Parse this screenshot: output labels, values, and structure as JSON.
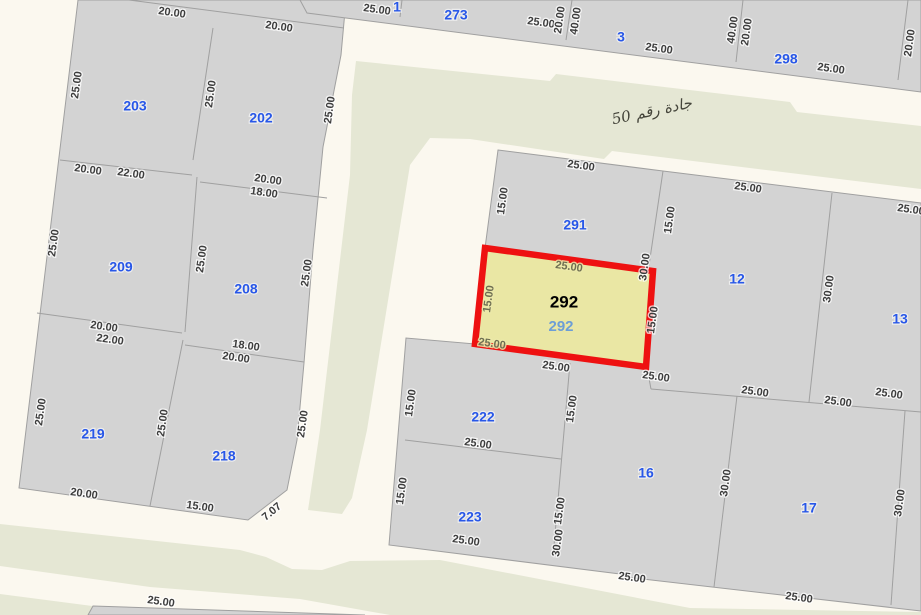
{
  "canvas": {
    "width": 921,
    "height": 615
  },
  "colors": {
    "road_background": "#fbf8ef",
    "street_pavement": "#e5e7d4",
    "parcel_fill": "#d3d3d3",
    "parcel_line": "#a0a0a0",
    "dimension_text": "#3d3d3d",
    "parcel_number_blue": "#2857e8",
    "selected_fill": "#eae7a4",
    "selected_border": "#ee1111",
    "selected_number_black": "#000000",
    "selected_number_blue": "#6d9ed6",
    "street_text": "#44443a"
  },
  "street": {
    "name": "جادة رقم 50",
    "x": 652,
    "y": 112,
    "angle": -12
  },
  "selected_parcel": {
    "number_black": "292",
    "number_blue": "292",
    "black_pos": {
      "x": 564,
      "y": 303
    },
    "blue_pos": {
      "x": 561,
      "y": 327
    },
    "points": "485,248 653,271 646,367 475,344"
  },
  "map": {
    "streets": [
      "356,61 550,81 556,74 790,102 797,112 921,126 921,189 612,151 604,159 470,139 430,138 410,165 367,430 352,498 342,514 308,510 320,430 350,175 352,95",
      "0,524 240,550 266,557 292,569 322,570 350,561 440,560 690,608 921,612 921,615 390,615 300,599 150,587 0,566",
      "0,594 100,607 96,615 0,615"
    ],
    "blocks": [
      "78,0 346,0 341,55 323,147 313,250 304,363 297,440 287,490 248,520 19,488",
      "300,0 921,0 921,92 307,13",
      "498,150 663,171 921,203 921,611 625,577 620,574 389,545 406,338 475,344 485,248",
      "93,606 365,615 88,615"
    ],
    "lines": [
      "129,0 344,28",
      "60,160 192,175",
      "200,182 327,198",
      "37,313 182,333",
      "185,345 304,362",
      "213,28 193,160",
      "197,177 185,332",
      "183,340 150,506",
      "402,0 400,17",
      "572,0 566,40",
      "743,0 736,62",
      "908,0 898,80",
      "663,171 648,272",
      "832,193 809,402",
      "647,368 651,389",
      "651,389 921,412",
      "405,440 561,459",
      "570,363 553,557",
      "737,396 714,587",
      "905,411 891,605"
    ],
    "dims": [
      {
        "t": "20.00",
        "x": 172,
        "y": 13,
        "r": 8
      },
      {
        "t": "20.00",
        "x": 279,
        "y": 27,
        "r": 8
      },
      {
        "t": "25.00",
        "x": 377,
        "y": 10,
        "r": 8
      },
      {
        "t": "25.00",
        "x": 541,
        "y": 23,
        "r": 8
      },
      {
        "t": "20.00",
        "x": 560,
        "y": 20,
        "r": -82
      },
      {
        "t": "40.00",
        "x": 576,
        "y": 21,
        "r": -82
      },
      {
        "t": "25.00",
        "x": 659,
        "y": 49,
        "r": 8
      },
      {
        "t": "40.00",
        "x": 733,
        "y": 30,
        "r": -82
      },
      {
        "t": "20.00",
        "x": 747,
        "y": 32,
        "r": -82
      },
      {
        "t": "25.00",
        "x": 831,
        "y": 69,
        "r": 8
      },
      {
        "t": "20.00",
        "x": 910,
        "y": 43,
        "r": -82
      },
      {
        "t": "25.00",
        "x": 77,
        "y": 85,
        "r": -82
      },
      {
        "t": "25.00",
        "x": 211,
        "y": 94,
        "r": -82
      },
      {
        "t": "25.00",
        "x": 330,
        "y": 110,
        "r": -82
      },
      {
        "t": "20.00",
        "x": 88,
        "y": 170,
        "r": 8
      },
      {
        "t": "22.00",
        "x": 131,
        "y": 174,
        "r": 8
      },
      {
        "t": "20.00",
        "x": 268,
        "y": 180,
        "r": 8
      },
      {
        "t": "18.00",
        "x": 264,
        "y": 193,
        "r": 8
      },
      {
        "t": "25.00",
        "x": 54,
        "y": 243,
        "r": -82
      },
      {
        "t": "25.00",
        "x": 202,
        "y": 259,
        "r": -82
      },
      {
        "t": "25.00",
        "x": 307,
        "y": 273,
        "r": -82
      },
      {
        "t": "20.00",
        "x": 104,
        "y": 327,
        "r": 8
      },
      {
        "t": "22.00",
        "x": 110,
        "y": 340,
        "r": 8
      },
      {
        "t": "18.00",
        "x": 246,
        "y": 346,
        "r": 8
      },
      {
        "t": "20.00",
        "x": 236,
        "y": 358,
        "r": 8
      },
      {
        "t": "25.00",
        "x": 41,
        "y": 412,
        "r": -82
      },
      {
        "t": "25.00",
        "x": 163,
        "y": 423,
        "r": -82
      },
      {
        "t": "25.00",
        "x": 303,
        "y": 424,
        "r": -82
      },
      {
        "t": "20.00",
        "x": 84,
        "y": 494,
        "r": 8
      },
      {
        "t": "15.00",
        "x": 200,
        "y": 507,
        "r": 8
      },
      {
        "t": "7.07",
        "x": 272,
        "y": 512,
        "r": -40
      },
      {
        "t": "25.00",
        "x": 581,
        "y": 166,
        "r": 8
      },
      {
        "t": "15.00",
        "x": 503,
        "y": 201,
        "r": -82
      },
      {
        "t": "15.00",
        "x": 670,
        "y": 220,
        "r": -82
      },
      {
        "t": "25.00",
        "x": 748,
        "y": 188,
        "r": 8
      },
      {
        "t": "30.00",
        "x": 829,
        "y": 289,
        "r": -82
      },
      {
        "t": "25.00",
        "x": 911,
        "y": 210,
        "r": 8
      },
      {
        "t": "30.00",
        "x": 645,
        "y": 267,
        "r": -82
      },
      {
        "t": "15.00",
        "x": 653,
        "y": 320,
        "r": -82
      },
      {
        "t": "25.00",
        "x": 569,
        "y": 267,
        "r": 8,
        "c": "olive"
      },
      {
        "t": "15.00",
        "x": 489,
        "y": 299,
        "r": -82,
        "c": "olive"
      },
      {
        "t": "25.00",
        "x": 492,
        "y": 344,
        "r": 8,
        "c": "olive"
      },
      {
        "t": "25.00",
        "x": 556,
        "y": 367,
        "r": 8
      },
      {
        "t": "25.00",
        "x": 656,
        "y": 377,
        "r": 8
      },
      {
        "t": "25.00",
        "x": 755,
        "y": 392,
        "r": 8
      },
      {
        "t": "25.00",
        "x": 838,
        "y": 402,
        "r": 8
      },
      {
        "t": "25.00",
        "x": 889,
        "y": 394,
        "r": 8
      },
      {
        "t": "15.00",
        "x": 411,
        "y": 403,
        "r": -82
      },
      {
        "t": "15.00",
        "x": 572,
        "y": 409,
        "r": -82
      },
      {
        "t": "25.00",
        "x": 478,
        "y": 444,
        "r": 8
      },
      {
        "t": "15.00",
        "x": 402,
        "y": 491,
        "r": -82
      },
      {
        "t": "25.00",
        "x": 466,
        "y": 541,
        "r": 8
      },
      {
        "t": "15.00",
        "x": 560,
        "y": 511,
        "r": -82
      },
      {
        "t": "30.00",
        "x": 558,
        "y": 543,
        "r": -82
      },
      {
        "t": "30.00",
        "x": 726,
        "y": 483,
        "r": -82
      },
      {
        "t": "30.00",
        "x": 900,
        "y": 503,
        "r": -82
      },
      {
        "t": "25.00",
        "x": 632,
        "y": 578,
        "r": 8
      },
      {
        "t": "25.00",
        "x": 799,
        "y": 598,
        "r": 8
      },
      {
        "t": "25.00",
        "x": 161,
        "y": 602,
        "r": 8
      }
    ],
    "parcel_numbers": [
      {
        "t": "1",
        "x": 397,
        "y": 8
      },
      {
        "t": "273",
        "x": 456,
        "y": 16
      },
      {
        "t": "3",
        "x": 621,
        "y": 38
      },
      {
        "t": "298",
        "x": 786,
        "y": 60
      },
      {
        "t": "203",
        "x": 135,
        "y": 107
      },
      {
        "t": "202",
        "x": 261,
        "y": 119
      },
      {
        "t": "209",
        "x": 121,
        "y": 268
      },
      {
        "t": "208",
        "x": 246,
        "y": 290
      },
      {
        "t": "219",
        "x": 93,
        "y": 435
      },
      {
        "t": "218",
        "x": 224,
        "y": 457
      },
      {
        "t": "291",
        "x": 575,
        "y": 226
      },
      {
        "t": "12",
        "x": 737,
        "y": 280
      },
      {
        "t": "13",
        "x": 900,
        "y": 320
      },
      {
        "t": "222",
        "x": 483,
        "y": 418
      },
      {
        "t": "223",
        "x": 470,
        "y": 518
      },
      {
        "t": "16",
        "x": 646,
        "y": 474
      },
      {
        "t": "17",
        "x": 809,
        "y": 509
      }
    ]
  }
}
